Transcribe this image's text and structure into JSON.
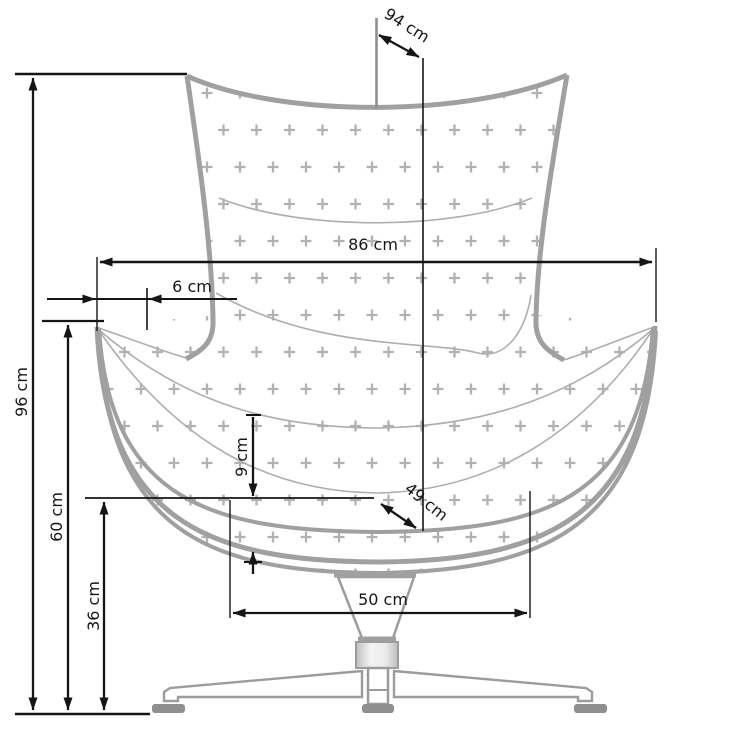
{
  "diagram": {
    "title": "Armchair technical dimension drawing",
    "unit": "cm",
    "dimensions": {
      "top_diagonal": "94 cm",
      "overall_width": "86 cm",
      "side_offset": "6 cm",
      "overall_height": "96 cm",
      "armrest_height": "60 cm",
      "seat_height": "36 cm",
      "cushion_thickness": "9 cm",
      "seat_diagonal": "49 cm",
      "seat_width": "50 cm"
    },
    "colors": {
      "background": "#ffffff",
      "shell_outline": "#a0a0a0",
      "seam_line": "#aeaeae",
      "plus_pattern": "#b2b2b2",
      "dimension_line": "#151515",
      "base_metal": "#9c9c9c",
      "foot_pad": "#8f8f8f"
    }
  }
}
